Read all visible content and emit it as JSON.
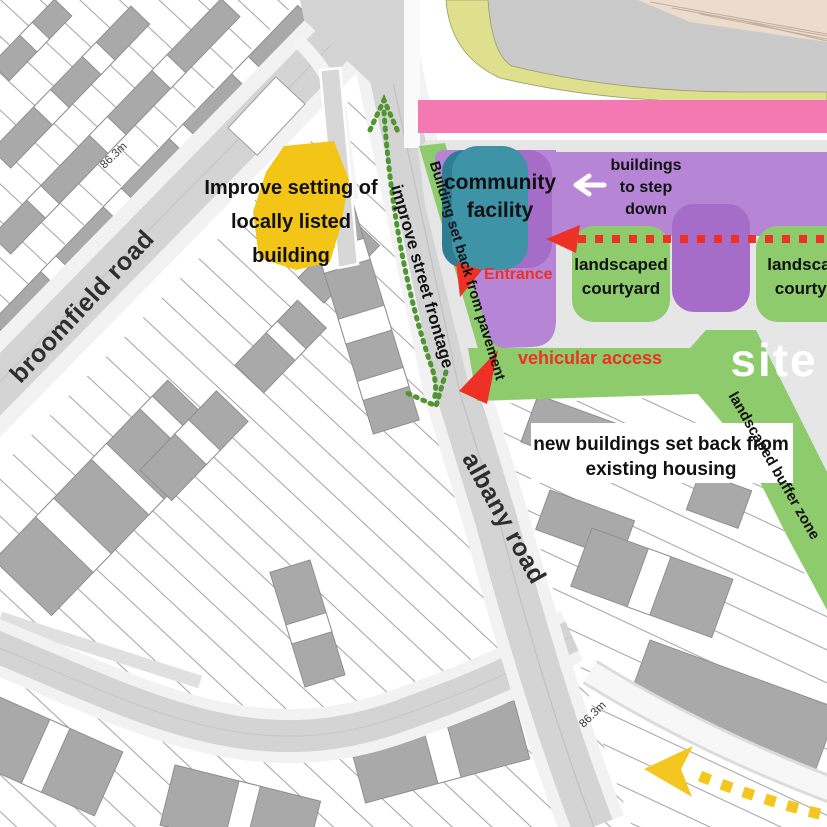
{
  "roads": {
    "broomfield": "broomfield road",
    "albany": "albany road"
  },
  "heights": {
    "north": "86.3m",
    "south": "86.3m"
  },
  "labels": {
    "listed1": "Improve setting of",
    "listed2": "locally listed",
    "listed3": "building",
    "community1": "community",
    "community2": "facility",
    "step1": "buildings",
    "step2": "to step",
    "step3": "down",
    "courtyard1a": "landscaped",
    "courtyard1b": "courtyard",
    "courtyard2a": "landscaped",
    "courtyard2b": "courtyard",
    "entrance": "Entrance",
    "vehicular": "vehicular access",
    "setback": "Building set back from pavement",
    "frontage": "improve street frontage",
    "buffer": "landscaped buffer zone",
    "newbuild1": "new buildings set back from",
    "newbuild2": "existing housing",
    "site": "site"
  },
  "colors": {
    "purple": "#b685d6",
    "purple_dark": "#a56cc8",
    "teal": "#3f93a7",
    "teal_dark": "#2e7d93",
    "green": "#8ecb6c",
    "pink": "#f479b2",
    "lime": "#dfe08d",
    "yellow_building": "#f2c517",
    "red": "#ee3124",
    "yellow_arrow": "#f3c71f",
    "green_arrow": "#4f9630",
    "road_gray": "#d4d4d4",
    "site_gray": "#e6e6e6",
    "building_gray": "#a9a9a9",
    "railway_gray": "#cacaca",
    "railway_beige": "#ecdccd"
  }
}
